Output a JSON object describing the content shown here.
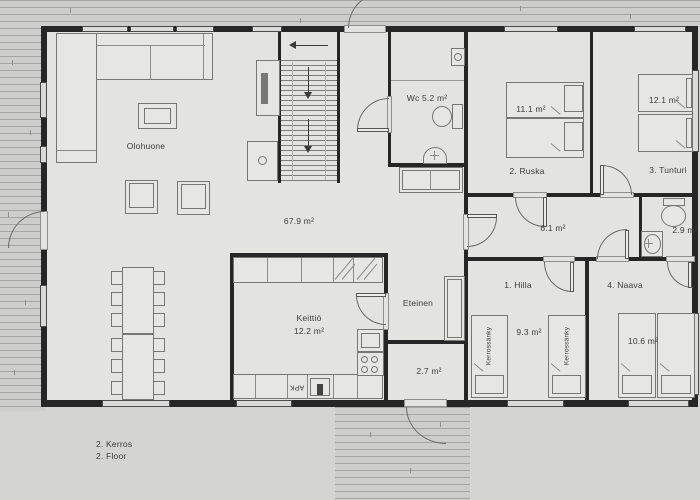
{
  "floor_labels": {
    "fi": "2. Kerros",
    "en": "2. Floor"
  },
  "rooms": {
    "olohuone": {
      "name": "Olohuone",
      "area": "67.9 m²"
    },
    "keittio": {
      "name": "Keittiö",
      "area": "12.2 m²"
    },
    "eteinen": {
      "name": "Eteinen"
    },
    "wc": {
      "label": "Wc 5.2 m²"
    },
    "hallway": {
      "area": "6.1 m²"
    },
    "wc_small": {
      "area": "2.9 m²"
    },
    "porch": {
      "area": "2.7 m²"
    },
    "ruska": {
      "name": "2. Ruska",
      "area": "11.1 m²"
    },
    "tunturi": {
      "name": "3. Tunturi",
      "area": "12.1 m²"
    },
    "hilla": {
      "name": "1. Hilla",
      "area": "9.3 m²"
    },
    "naava": {
      "name": "4. Naava",
      "area": "10.6 m²"
    }
  },
  "furniture": {
    "dishwasher": "APK",
    "bunk_bed": "Kerrossänky"
  },
  "colors": {
    "wall": "#262626",
    "floor": "#e3e3e1",
    "background": "#d4d4d3",
    "deck_line": "#a5a5a3",
    "furniture_line": "#767674",
    "text": "#3c3c3c"
  }
}
